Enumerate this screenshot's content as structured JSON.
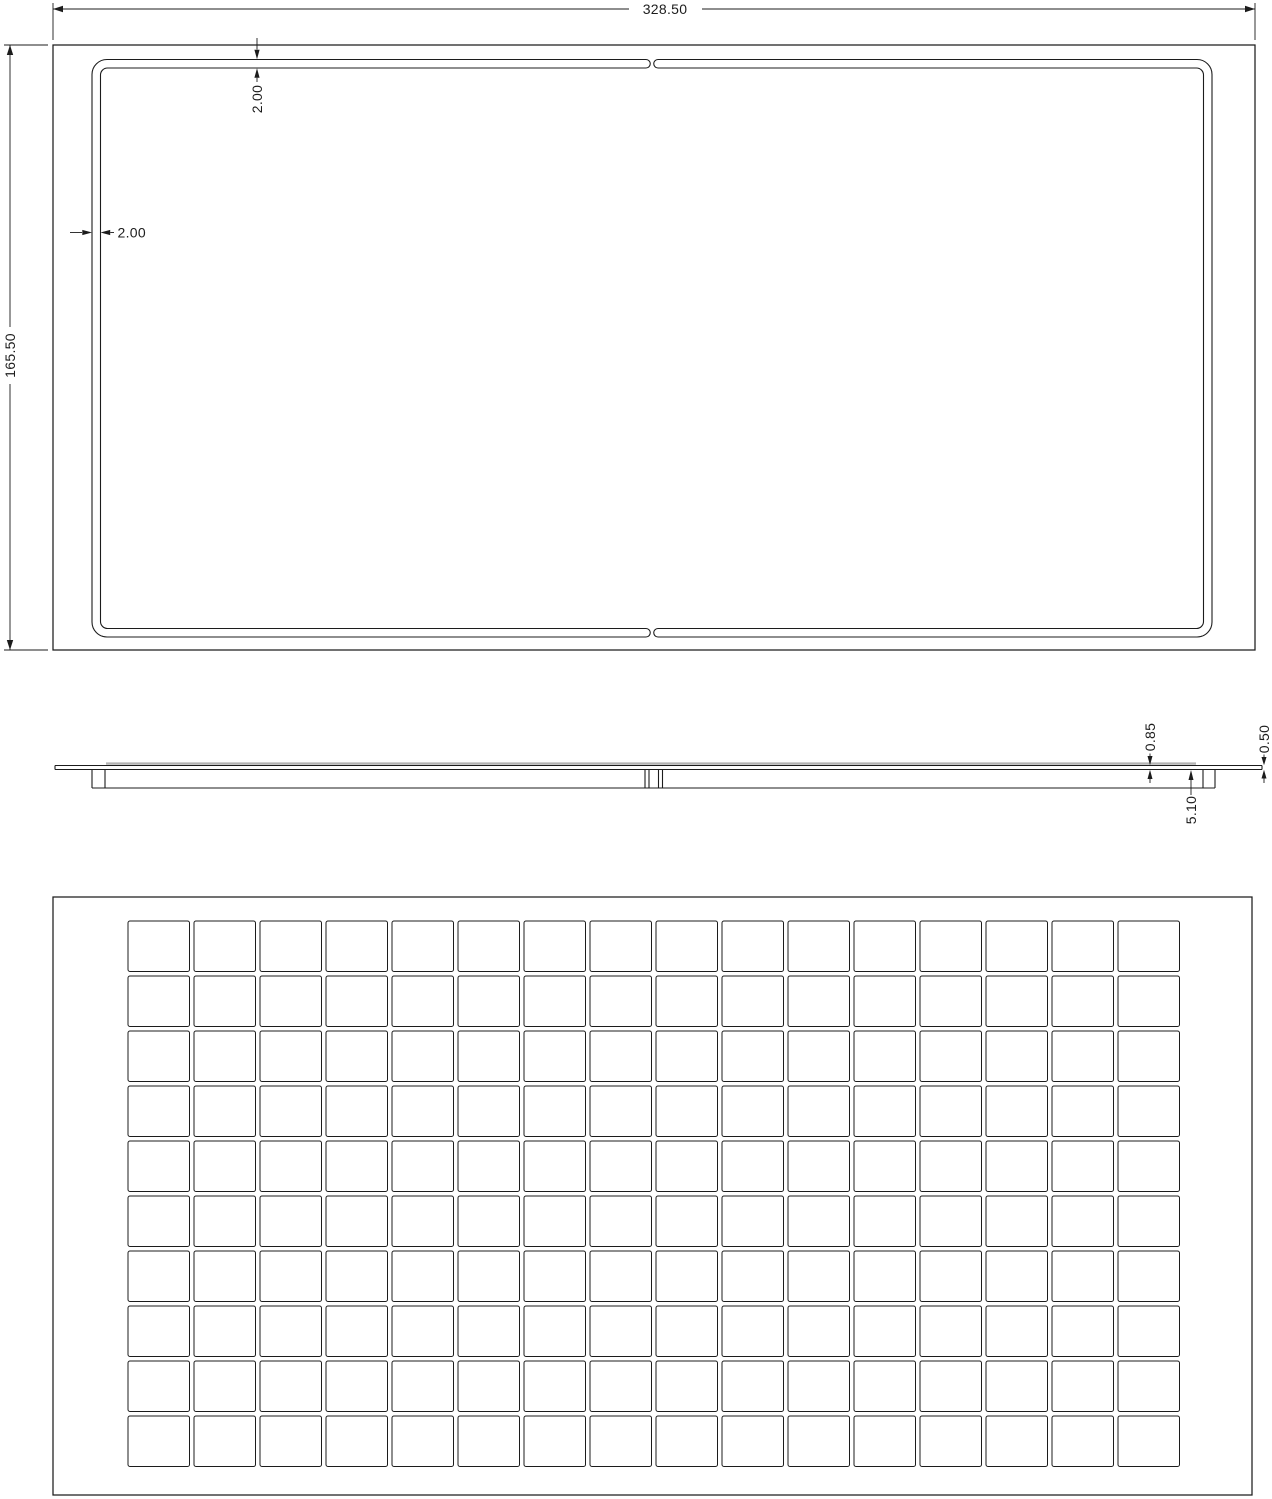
{
  "sheet": {
    "background": "#ffffff",
    "line_color": "#1c1c1c",
    "shadow_gray": "#b3b3b3"
  },
  "top_view": {
    "dim_overall_width": "328.50",
    "dim_overall_height": "165.50",
    "dim_groove_width_top": "2.00",
    "dim_groove_width_left": "2.00"
  },
  "side_view": {
    "dim_top_plate_thickness": "0.85",
    "dim_overall_depth": "5.10",
    "dim_edge_thickness": "0.50"
  },
  "bottom_view": {
    "grid": {
      "rows": 10,
      "cols": 16
    }
  }
}
